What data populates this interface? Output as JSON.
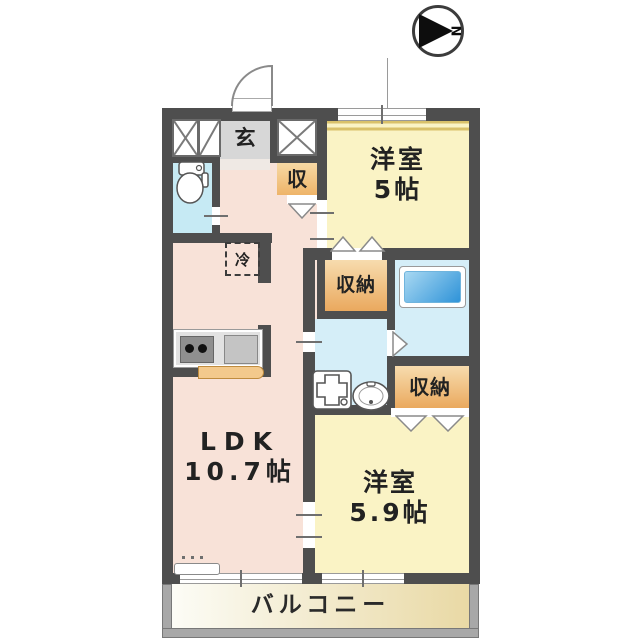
{
  "compass": {
    "north_label": "N"
  },
  "plan": {
    "entrance": {
      "label": "玄"
    },
    "storage_small": {
      "label": "収"
    },
    "refrigerator": {
      "label": "冷"
    },
    "bedroom1": {
      "name": "洋室",
      "size": "5帖"
    },
    "closet1": {
      "label": "収納"
    },
    "closet2": {
      "label": "収納"
    },
    "ldk": {
      "name": "LDK",
      "size": "10.7帖"
    },
    "bedroom2": {
      "name": "洋室",
      "size": "5.9帖"
    },
    "balcony": {
      "label": "バルコニー"
    }
  },
  "colors": {
    "wall": "#4e4e4e",
    "ldk_pink": "#f8e2d8",
    "bedroom_yellow": "#faf3c5",
    "closet_orange": "#f0bf7d",
    "water_blue": "#d5eef8",
    "toilet_blue": "#c6eaf4",
    "tub_blue": "#2f93d8",
    "entrance_gray": "#d7d7d7",
    "balcony_tan": "#e9d9a5"
  }
}
